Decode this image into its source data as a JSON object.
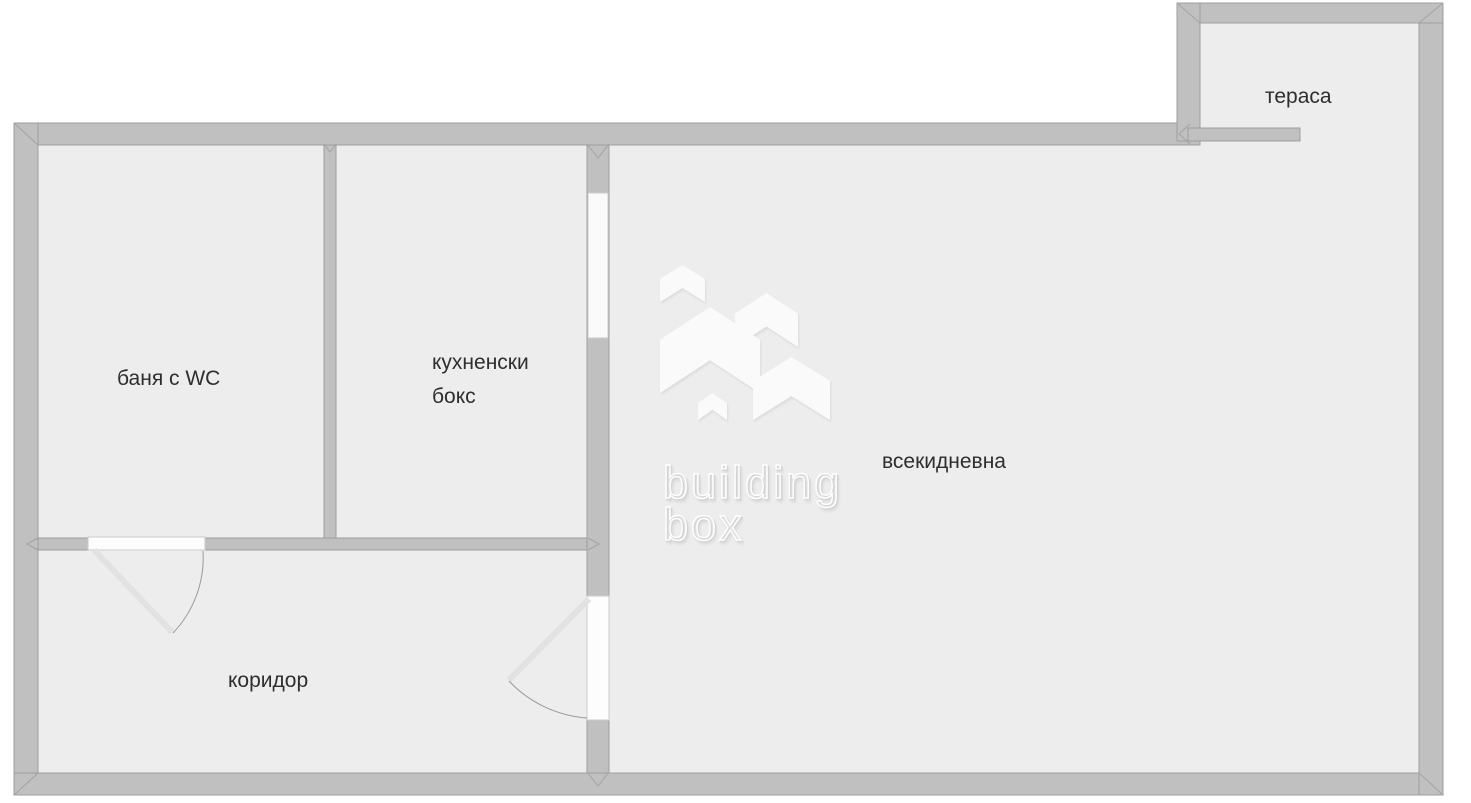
{
  "floorplan": {
    "rooms": {
      "bathroom": {
        "label": "баня с WC"
      },
      "kitchen": {
        "label_line1": "кухненски",
        "label_line2": "бокс"
      },
      "living_room": {
        "label": "всекидневна"
      },
      "corridor": {
        "label": "коридор"
      },
      "terrace": {
        "label": "тераса"
      }
    },
    "watermark": {
      "brand_line1": "building",
      "brand_line2": "box",
      "logo_icon": "buildingbox-houses-logo"
    },
    "colors": {
      "wall_fill": "#c0c0c0",
      "wall_outline": "#9e9e9e",
      "floor_fill": "#ededed",
      "opening_fill": "#fdfdfd",
      "window_fill": "#fafafa",
      "background": "#ffffff",
      "label_text": "#2e2e2e"
    }
  }
}
